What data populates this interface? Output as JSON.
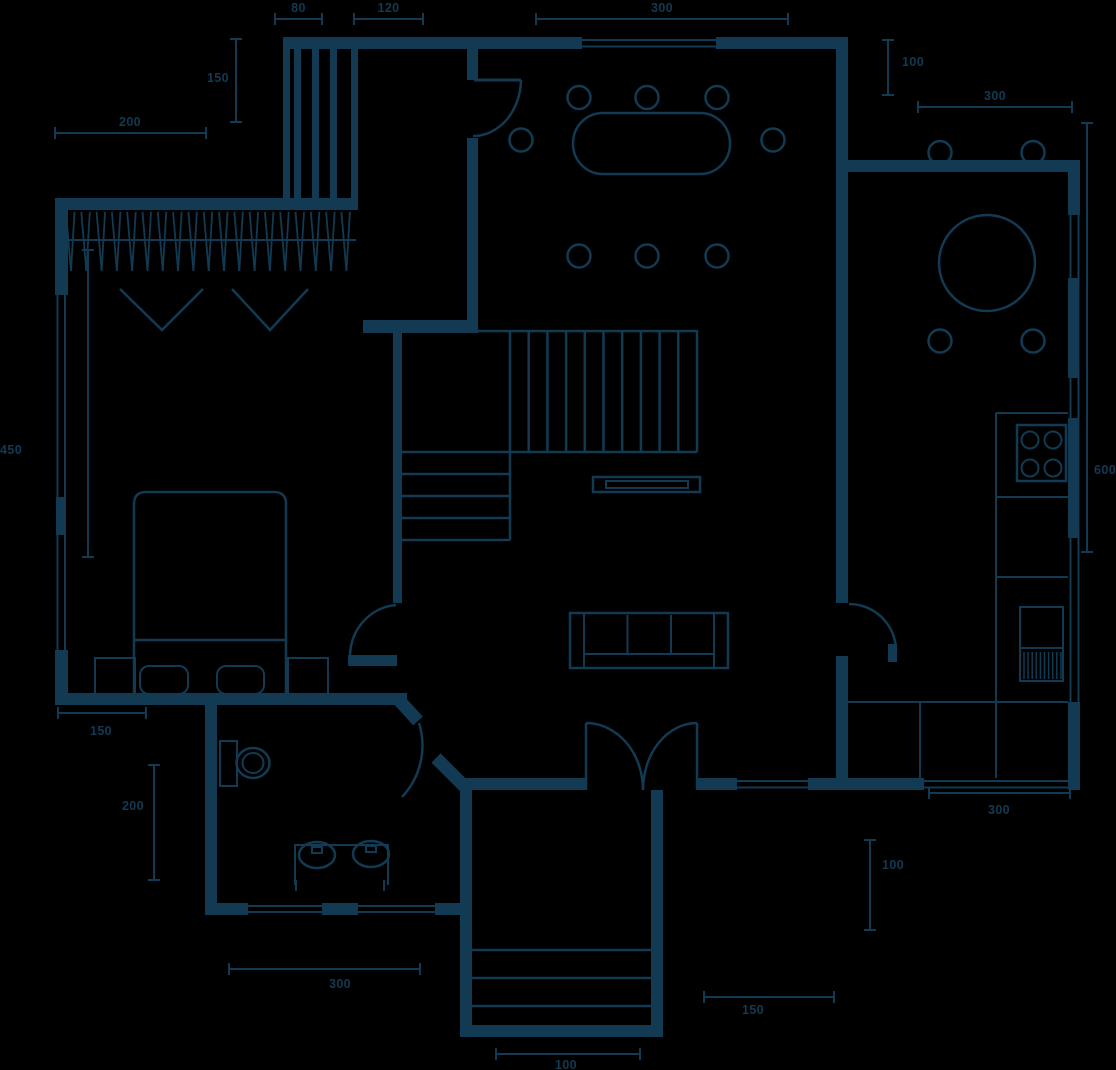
{
  "plan": {
    "type": "architectural-floor-plan",
    "colors": {
      "line": "#123a52",
      "background": "#000000"
    },
    "dimensions": {
      "w80": "80",
      "w120": "120",
      "w300_top": "300",
      "h150_closet": "150",
      "w200_top": "200",
      "h100_dining": "100",
      "w300_kitchen_top": "300",
      "h450_window": "450",
      "h600_kitchen": "600",
      "w150_bed": "150",
      "h200_bath": "200",
      "w300_bath": "300",
      "w100_steps": "100",
      "w150_porch": "150",
      "h100_kitchen": "100",
      "w300_kitchen_bottom": "300"
    },
    "symbols": [
      "wardrobe",
      "closet-hangers",
      "bed",
      "pillows",
      "nightstands",
      "dining-table",
      "dining-chairs",
      "staircase",
      "tv-console",
      "sofa",
      "kitchen-round-table",
      "kitchen-chairs",
      "stove",
      "kitchen-sink",
      "kitchen-counter",
      "toilet",
      "vanity-double-sink",
      "door-arcs",
      "double-entry-door",
      "windows",
      "porch-steps"
    ]
  }
}
